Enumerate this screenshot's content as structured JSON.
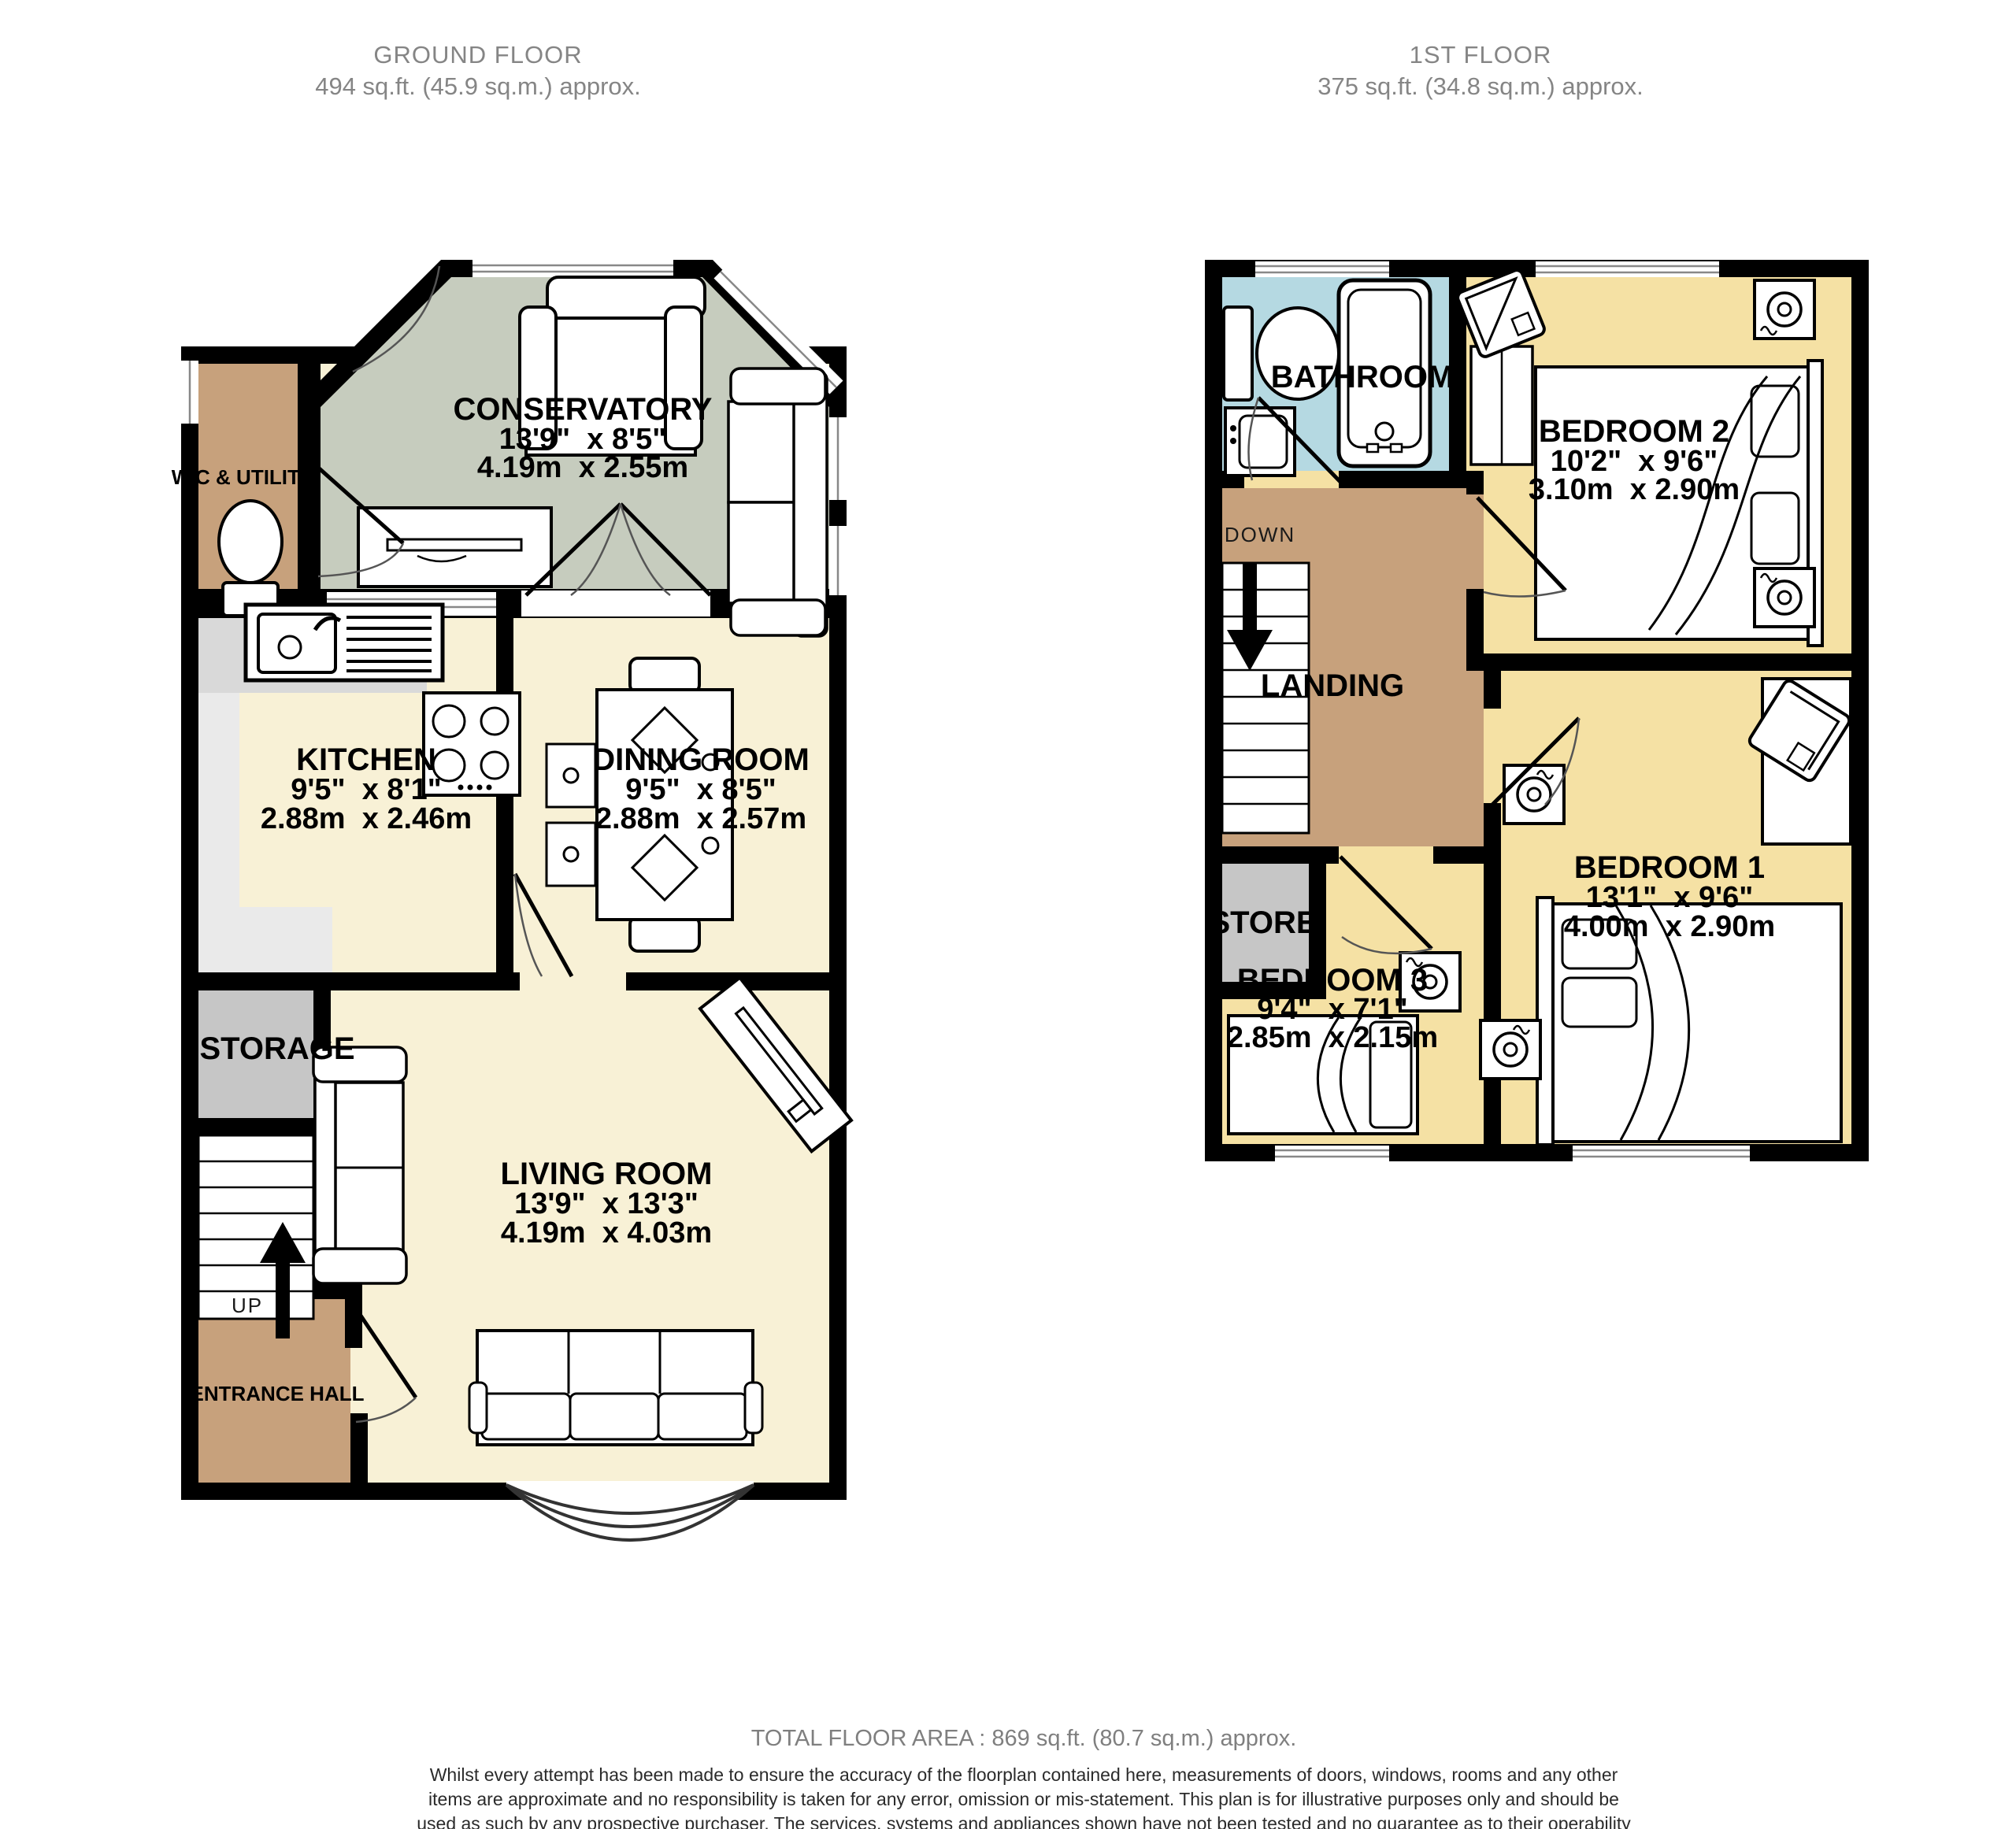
{
  "floors": [
    {
      "id": "ground",
      "title": "GROUND FLOOR",
      "subtitle": "494 sq.ft. (45.9 sq.m.) approx.",
      "stair_label": "UP",
      "rooms": [
        {
          "name": "CONSERVATORY",
          "imperial": "13'9\"  x 8'5\"",
          "metric": "4.19m  x 2.55m"
        },
        {
          "name": "W.C & UTILITY"
        },
        {
          "name": "KITCHEN",
          "imperial": "9'5\"  x 8'1\"",
          "metric": "2.88m  x 2.46m"
        },
        {
          "name": "DINING ROOM",
          "imperial": "9'5\"  x 8'5\"",
          "metric": "2.88m  x 2.57m"
        },
        {
          "name": "STORAGE"
        },
        {
          "name": "LIVING ROOM",
          "imperial": "13'9\"  x 13'3\"",
          "metric": "4.19m  x 4.03m"
        },
        {
          "name": "ENTRANCE HALL"
        }
      ]
    },
    {
      "id": "first",
      "title": "1ST FLOOR",
      "subtitle": "375 sq.ft. (34.8 sq.m.) approx.",
      "stair_label": "DOWN",
      "rooms": [
        {
          "name": "BATHROOM"
        },
        {
          "name": "BEDROOM 2",
          "imperial": "10'2\"  x 9'6\"",
          "metric": "3.10m  x 2.90m"
        },
        {
          "name": "LANDING"
        },
        {
          "name": "STORE"
        },
        {
          "name": "BEDROOM 1",
          "imperial": "13'1\"  x 9'6\"",
          "metric": "4.00m  x 2.90m"
        },
        {
          "name": "BEDROOM 3",
          "imperial": "9'4\"  x 7'1\"",
          "metric": "2.85m  x 2.15m"
        }
      ]
    }
  ],
  "footer": {
    "total_area": "TOTAL FLOOR AREA : 869 sq.ft. (80.7 sq.m.) approx.",
    "disclaimer": "Whilst every attempt has been made to ensure the accuracy of the floorplan contained here, measurements of doors, windows, rooms and any other items are approximate and no responsibility is taken for any error, omission or mis-statement. This plan is for illustrative purposes only and should be used as such by any prospective purchaser. The services, systems and appliances shown have not been tested and no guarantee as to their operability or efficiency can be given.",
    "credit": "Made with Metropix ©2026"
  },
  "colors": {
    "wall": "#000000",
    "cream": "#f8f1d6",
    "sage": "#c6ccbe",
    "brown": "#c7a17c",
    "yellow": "#f5e1a4",
    "blue": "#b5d9e2",
    "gray_room": "#c6c6c6",
    "counter": "#d9d9d9",
    "counter_light": "#eaeaea",
    "title_gray": "#858585"
  }
}
